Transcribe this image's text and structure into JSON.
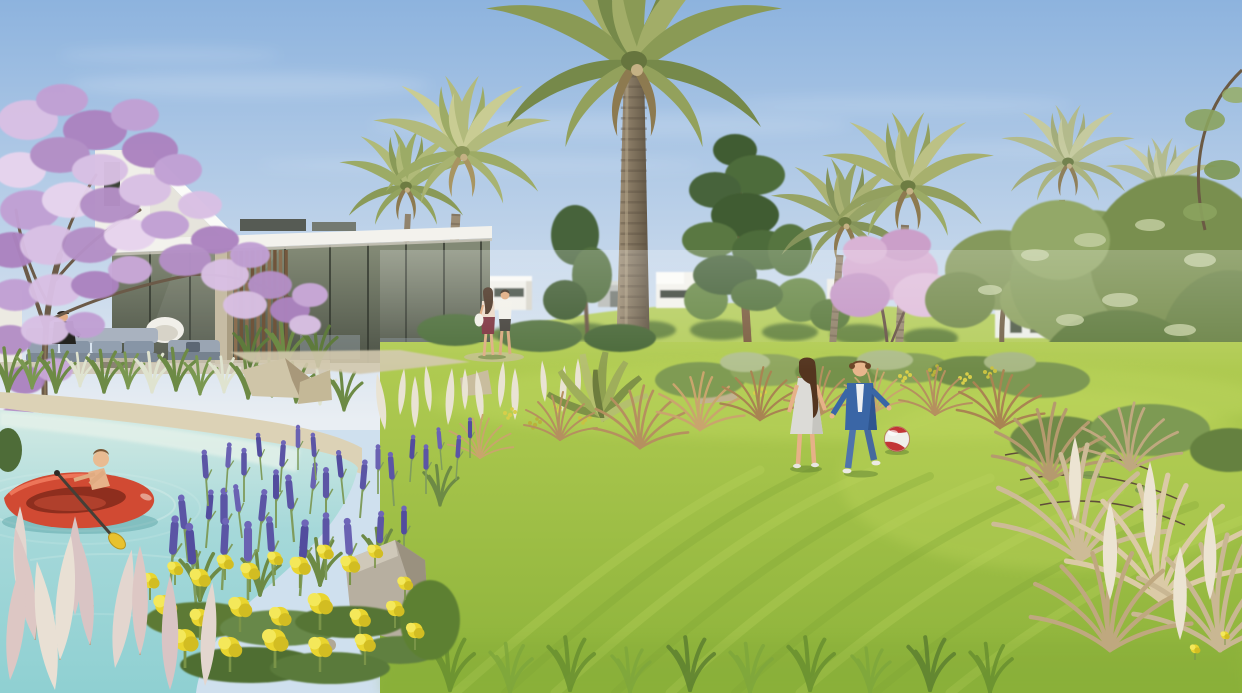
{
  "scene": {
    "type": "architectural-rendering",
    "title": "Resort community garden rendering",
    "description": "Sunny rendering of a landscaped resort garden: a modern white villa with a covered glass terrace overlooks a lagoon-style pool where a boy paddles a red inflatable raft; a large lawn with two children playing ball, a strolling couple, jacaranda trees in purple bloom, date palms, pines and olive trees, with lavender, yellow wildflowers and ornamental grasses in the foreground.",
    "setting": "daytime, clear blue sky",
    "elements": [
      "sky",
      "clouds",
      "grass-hill",
      "distant-villas",
      "modern-villa",
      "roof-canopy",
      "glass-facade",
      "wood-slat-screen",
      "terrace-lounge",
      "seated-person",
      "jacaranda-tree-left",
      "jacaranda-tree-center",
      "jacaranda-tree-right",
      "palm-group-left",
      "tall-date-palm",
      "palm-pair-right",
      "palms-far-right",
      "pine-tree",
      "olive-trees",
      "shrub-band",
      "lagoon-pool",
      "sandy-pool-edge",
      "red-inflatable-raft",
      "child-paddler",
      "paddle",
      "pool-ripples",
      "rocks",
      "boulder",
      "gravel-path",
      "white-plume-grasses",
      "dry-ornamental-grasses",
      "fan-palm-sapling",
      "lawn",
      "mowing-streaks",
      "strolling-couple",
      "girl-playing",
      "boy-playing",
      "play-ball",
      "lavender-bed",
      "yellow-wildflowers",
      "pink-plume-grasses",
      "twig-branches"
    ]
  },
  "palette": {
    "sky_top": "#8db3de",
    "sky_mid": "#c2d5ea",
    "sky_horizon": "#e9eef3",
    "hill_grass": "#b6ce60",
    "lawn_back": "#b2cc53",
    "lawn_front": "#8cb23a",
    "pool_shallow": "#d8ece5",
    "pool_mid": "#a5d8d9",
    "pool_deep": "#8fd0d2",
    "sand": "#dcd2b6",
    "villa_white": "#f3f2ed",
    "glass_top": "#828975",
    "glass_bottom": "#4c5246",
    "wood_slat": "#85694c",
    "jacaranda_purple": "#bb93cc",
    "jacaranda_pink": "#d5abd1",
    "palm_green": "#8a9a55",
    "pine_green": "#46633a",
    "olive_green": "#7d9355",
    "trunk_brown": "#8d7c64",
    "lavender_purple": "#5b55a5",
    "wildflower_yellow": "#e9d52f",
    "plume_cream": "#e9e3d3",
    "plume_pink": "#ddc7c4",
    "dry_grass": "#b5905f",
    "rock_beige": "#cfc5a8",
    "boulder_grey": "#b7afa0",
    "raft_red": "#d14a33",
    "paddle_yellow": "#e8c22e",
    "skin": "#e7b289",
    "girl_dress": "#dcdbd7",
    "boy_denim": "#3a66a6",
    "ball_red": "#c23636",
    "ball_white": "#f0efeb",
    "sofa_grey": "#9fabb8"
  }
}
